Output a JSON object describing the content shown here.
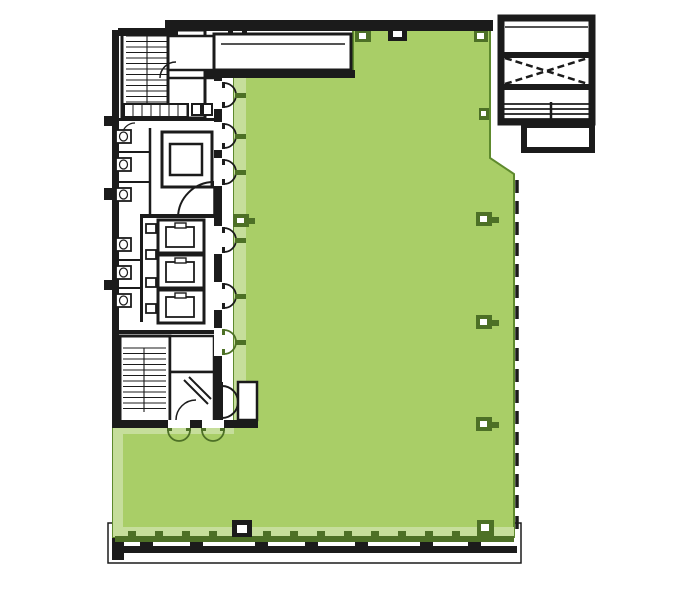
{
  "canvas": {
    "width": 681,
    "height": 597,
    "background": "#ffffff"
  },
  "colors": {
    "green": "#a9ce67",
    "greenLight": "#c6de9b",
    "greenDark": "#4d7026",
    "greenBorder": "#5e8a2d",
    "black": "#1b1b1b",
    "white": "#ffffff"
  },
  "plan": {
    "office": {
      "points": "353,30 490,30 490,158 514,174 514,537 113,537 113,425 234,425 234,75 353,75",
      "bands": [
        [
          234,
          75,
          12,
          350
        ],
        [
          113,
          425,
          10,
          112
        ],
        [
          123,
          425,
          111,
          9
        ],
        [
          116,
          527,
          398,
          10
        ]
      ]
    },
    "curtain": {
      "band": [
        115,
        536,
        399,
        6
      ],
      "tickY": 531,
      "tickW": 8,
      "tickH": 5,
      "tickX0": 128,
      "tickX1": 505,
      "tickStep": 27,
      "dash": {
        "x": 517,
        "y0": 180,
        "y1": 537,
        "w": 3.5,
        "pattern": "13 8"
      }
    },
    "terrace": {
      "outer": [
        108,
        523,
        413,
        40
      ],
      "band": [
        113,
        546,
        404,
        7
      ],
      "posts": [
        140,
        190,
        255,
        305,
        355,
        420,
        468
      ],
      "postY": 542,
      "postW": 13,
      "postH": 5,
      "blob": [
        112,
        538,
        12,
        22
      ]
    },
    "roof": {
      "outer": [
        501,
        18,
        91,
        104
      ],
      "outerSw": 7,
      "topline": [
        505,
        27,
        588,
        27
      ],
      "walls": [
        [
          502,
          52,
          89,
          6
        ],
        [
          502,
          84,
          89,
          6
        ]
      ],
      "brace": [
        [
          505,
          58,
          588,
          84
        ],
        [
          505,
          84,
          588,
          58
        ]
      ],
      "hlinesY": [
        104,
        109,
        114,
        119
      ],
      "hx0": 502,
      "hx1": 591,
      "vtick": [
        551,
        102,
        551,
        128
      ],
      "ext": [
        524,
        125,
        68,
        25
      ],
      "extSw": 6
    },
    "columns": [
      {
        "x": 355,
        "y": 30,
        "w": 16,
        "h": 12,
        "c": "dark",
        "i": [
          359,
          33,
          7,
          6
        ]
      },
      {
        "x": 474,
        "y": 30,
        "w": 14,
        "h": 12,
        "c": "dark",
        "i": [
          477,
          33,
          7,
          6
        ]
      },
      {
        "x": 479,
        "y": 108,
        "w": 10,
        "h": 12,
        "c": "dark",
        "i": [
          481,
          111,
          5,
          5
        ]
      },
      {
        "x": 476,
        "y": 212,
        "w": 16,
        "h": 14,
        "c": "dark",
        "i": [
          480,
          216,
          7,
          6
        ],
        "s": [
          492,
          217,
          7,
          6
        ]
      },
      {
        "x": 476,
        "y": 315,
        "w": 16,
        "h": 14,
        "c": "dark",
        "i": [
          480,
          319,
          7,
          6
        ],
        "s": [
          492,
          320,
          7,
          6
        ]
      },
      {
        "x": 476,
        "y": 417,
        "w": 16,
        "h": 14,
        "c": "dark",
        "i": [
          480,
          421,
          7,
          6
        ],
        "s": [
          492,
          422,
          7,
          6
        ]
      },
      {
        "x": 233,
        "y": 214,
        "w": 16,
        "h": 13,
        "c": "dark",
        "i": [
          237,
          218,
          7,
          5
        ],
        "s": [
          249,
          218,
          6,
          6
        ]
      },
      {
        "x": 232,
        "y": 520,
        "w": 20,
        "h": 17,
        "c": "black",
        "i": [
          237,
          525,
          10,
          8
        ]
      },
      {
        "x": 477,
        "y": 520,
        "w": 17,
        "h": 16,
        "c": "dark",
        "i": [
          481,
          524,
          8,
          7
        ]
      },
      {
        "x": 228,
        "y": 26,
        "w": 19,
        "h": 15,
        "c": "black",
        "i": [
          233,
          30,
          9,
          7
        ]
      },
      {
        "x": 388,
        "y": 26,
        "w": 19,
        "h": 15,
        "c": "black",
        "i": [
          393,
          30,
          9,
          7
        ]
      }
    ],
    "rooms": [
      [
        122,
        30,
        83,
        88,
        3
      ],
      [
        168,
        36,
        46,
        34,
        2.5
      ],
      [
        214,
        34,
        137,
        36,
        3
      ],
      [
        162,
        132,
        50,
        55,
        3
      ],
      [
        170,
        144,
        32,
        31,
        2.5
      ],
      [
        120,
        336,
        50,
        87,
        3
      ],
      [
        170,
        336,
        44,
        36,
        2.5
      ],
      [
        170,
        372,
        44,
        51,
        2.5
      ],
      [
        238,
        382,
        19,
        38,
        2.5
      ],
      [
        192,
        104,
        9,
        11,
        2
      ],
      [
        203,
        104,
        9,
        11,
        2
      ]
    ],
    "walls": [
      [
        165,
        20,
        328,
        11
      ],
      [
        118,
        28,
        60,
        8
      ],
      [
        112,
        30,
        7,
        398
      ],
      [
        206,
        70,
        149,
        8
      ],
      [
        112,
        118,
        104,
        3
      ],
      [
        140,
        214,
        78,
        4
      ],
      [
        112,
        330,
        104,
        4
      ],
      [
        214,
        70,
        8,
        11
      ],
      [
        214,
        109,
        8,
        13
      ],
      [
        214,
        150,
        8,
        8
      ],
      [
        214,
        186,
        8,
        40
      ],
      [
        214,
        254,
        8,
        28
      ],
      [
        214,
        310,
        8,
        18
      ],
      [
        214,
        356,
        8,
        67
      ],
      [
        112,
        420,
        56,
        8
      ],
      [
        190,
        420,
        12,
        8
      ],
      [
        224,
        420,
        34,
        8
      ],
      [
        140,
        218,
        3,
        104
      ],
      [
        104,
        116,
        8,
        10
      ],
      [
        104,
        188,
        8,
        12
      ],
      [
        104,
        280,
        8,
        10
      ]
    ],
    "treads": [
      {
        "x1": 126,
        "x2": 168,
        "y0": 36,
        "y1": 112,
        "step": 5.5,
        "mid": 147
      },
      {
        "x1": 123,
        "x2": 166,
        "y0": 348,
        "y1": 412,
        "step": 5.5,
        "mid": 144
      }
    ],
    "lines": [
      [
        221,
        44,
        345,
        44,
        1.5
      ],
      [
        168,
        36,
        168,
        115,
        3
      ],
      [
        168,
        78,
        214,
        78,
        2.5
      ],
      [
        150,
        128,
        150,
        214,
        2.5
      ],
      [
        112,
        152,
        150,
        152,
        2
      ],
      [
        112,
        182,
        150,
        182,
        2
      ],
      [
        112,
        260,
        142,
        260,
        2
      ],
      [
        112,
        288,
        142,
        288,
        2
      ],
      [
        214,
        182,
        214,
        218,
        1.5
      ],
      [
        184,
        380,
        208,
        404,
        2
      ],
      [
        189,
        377,
        211,
        399,
        2
      ],
      [
        222,
        382,
        222,
        420,
        2
      ]
    ],
    "arcs": [
      [
        "M 178 218 A 36 36 0 0 1 214 182",
        2,
        "black"
      ],
      [
        "M 160 78 A 16 16 0 0 1 176 62",
        1.5,
        "black"
      ],
      [
        "M 122 136 A 13 13 0 0 1 135 123",
        1.2,
        "black"
      ],
      [
        "M 176 420 A 20 20 0 0 1 196 400",
        1.5,
        "black"
      ],
      [
        "M 222 386 A 16 16 0 0 1 238 402",
        2,
        "black"
      ],
      [
        "M 222 418 A 16 16 0 0 0 238 402",
        2,
        "black"
      ]
    ],
    "fixtures": [
      [
        116,
        130
      ],
      [
        116,
        158
      ],
      [
        116,
        188
      ],
      [
        116,
        238
      ],
      [
        116,
        266
      ],
      [
        116,
        294
      ]
    ],
    "elevators": [
      [
        158,
        220
      ],
      [
        158,
        255
      ],
      [
        158,
        290
      ]
    ],
    "ducts": [
      [
        146,
        224
      ],
      [
        146,
        250
      ],
      [
        146,
        278
      ],
      [
        146,
        304
      ]
    ],
    "counter": {
      "x": 124,
      "y": 104,
      "w": 64,
      "h": 13,
      "step": 9
    },
    "edge_doors": {
      "wallX": 214,
      "gapW": 8,
      "r": 12,
      "black_ys": [
        95,
        136,
        172,
        240,
        296
      ],
      "green_ys": [
        342
      ]
    },
    "bottom_doors": {
      "wallY": 420,
      "xs": [
        179,
        213
      ],
      "r": 11
    }
  }
}
